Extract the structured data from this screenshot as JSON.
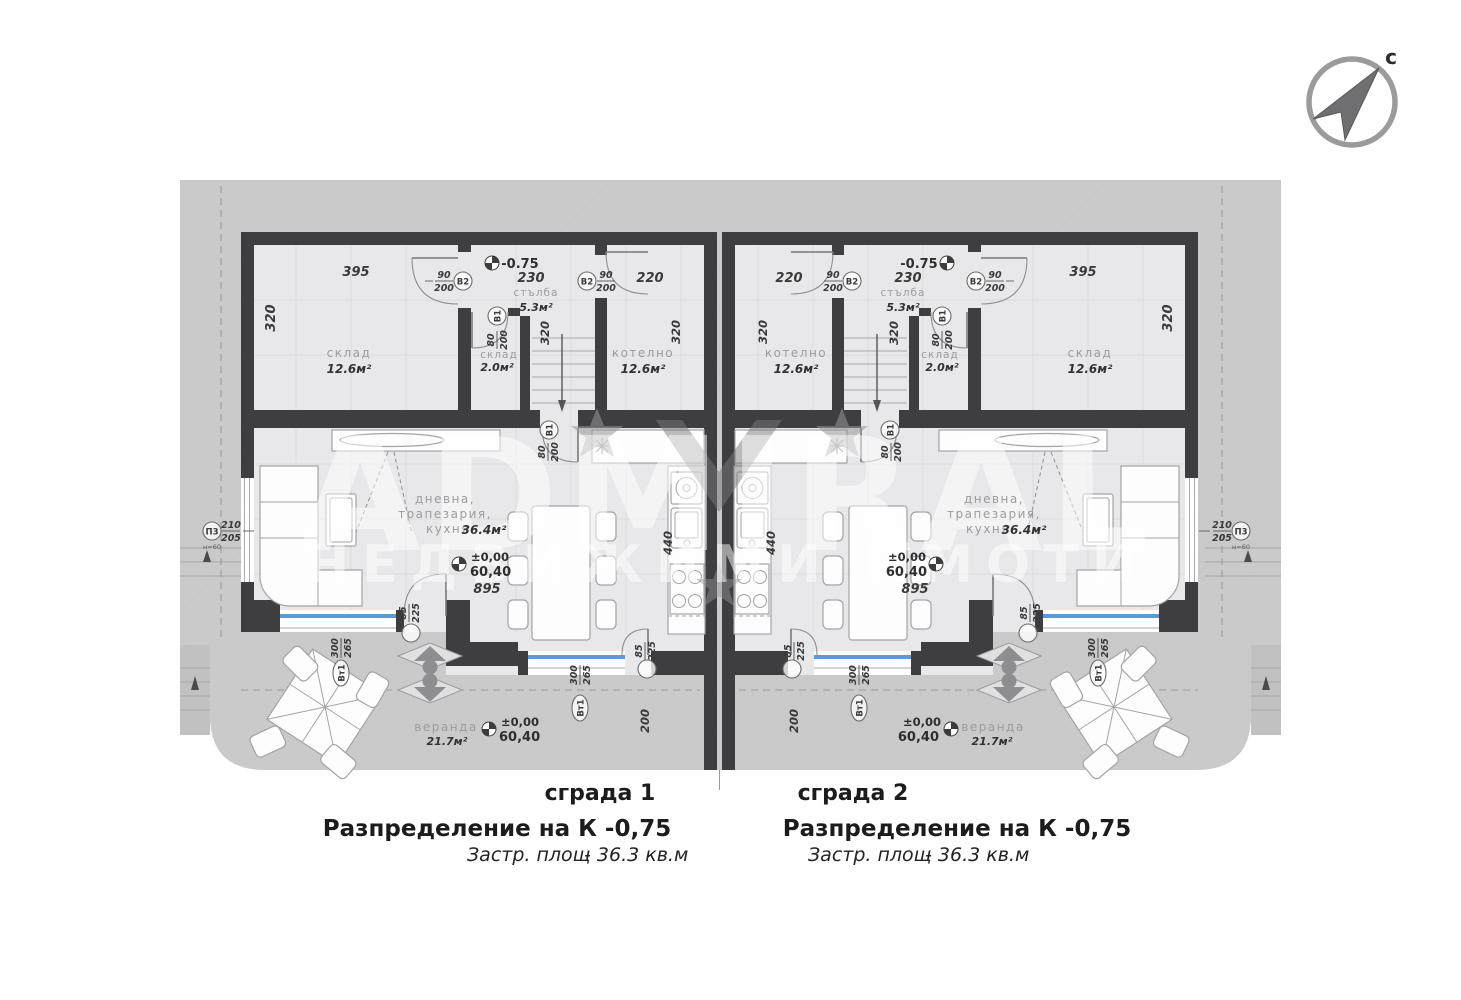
{
  "compass": {
    "label": "с"
  },
  "watermark": {
    "line1": "ADMIRAL",
    "line2": "НЕДВИЖИМИ ИМОТИ"
  },
  "b1": {
    "title": "сграда 1",
    "subtitle": "Разпределение на К -0,75",
    "area_label": "Застр. площ",
    "area_value": "- 36.3 кв.м",
    "room_storage": "склад",
    "room_storage_area": "12.6м²",
    "room_stairs": "стълба",
    "room_stairs_area": "5.3м²",
    "room_storage2": "склад",
    "room_storage2_area": "2.0м²",
    "room_boiler": "котелно",
    "room_boiler_area": "12.6м²",
    "room_living1": "дневна,",
    "room_living2": "трапезария,",
    "room_living3": "кухня",
    "room_living_area": "36.4м²",
    "room_veranda": "веранда",
    "room_veranda_area": "21.7м²",
    "dim_storage_w": "395",
    "dim_stairs_w": "230",
    "dim_boiler_w": "220",
    "dim_depth": "320",
    "dim_kitchen": "440",
    "dim_living_w": "895",
    "dim_veranda_d": "200",
    "level_base": "-0.75",
    "level_zero": "±0,00",
    "level_abs": "60,40",
    "door_main_num": "90",
    "door_main_den": "200",
    "tag_door_main": "В2",
    "door_int_num": "80",
    "door_int_den": "200",
    "tag_door_int": "В1",
    "win_num": "300",
    "win_den": "265",
    "tag_win": "Вт1",
    "door_ter_num": "85",
    "door_ter_den": "225",
    "win_side_num": "210",
    "win_side_den": "205",
    "tag_win_side": "П3",
    "note_side": "н=60"
  },
  "b2": {
    "title": "сграда 2",
    "subtitle": "Разпределение на К -0,75",
    "area_label": "Застр. площ",
    "area_value": "- 36.3 кв.м",
    "room_storage": "склад",
    "room_storage_area": "12.6м²",
    "room_stairs": "стълба",
    "room_stairs_area": "5.3м²",
    "room_storage2": "склад",
    "room_storage2_area": "2.0м²",
    "room_boiler": "котелно",
    "room_boiler_area": "12.6м²",
    "room_living1": "дневна,",
    "room_living2": "трапезария,",
    "room_living3": "кухня",
    "room_living_area": "36.4м²",
    "room_veranda": "веранда",
    "room_veranda_area": "21.7м²",
    "dim_storage_w": "395",
    "dim_stairs_w": "230",
    "dim_boiler_w": "220",
    "dim_depth": "320",
    "dim_kitchen": "440",
    "dim_living_w": "895",
    "dim_veranda_d": "200",
    "level_base": "-0.75",
    "level_zero": "±0,00",
    "level_abs": "60,40",
    "door_main_num": "90",
    "door_main_den": "200",
    "tag_door_main": "В2",
    "door_int_num": "80",
    "door_int_den": "200",
    "tag_door_int": "В1",
    "win_num": "300",
    "win_den": "265",
    "tag_win": "Вт1",
    "door_ter_num": "85",
    "door_ter_den": "225",
    "win_side_num": "210",
    "win_side_den": "205",
    "tag_win_side": "П3",
    "note_side": "н=60"
  }
}
